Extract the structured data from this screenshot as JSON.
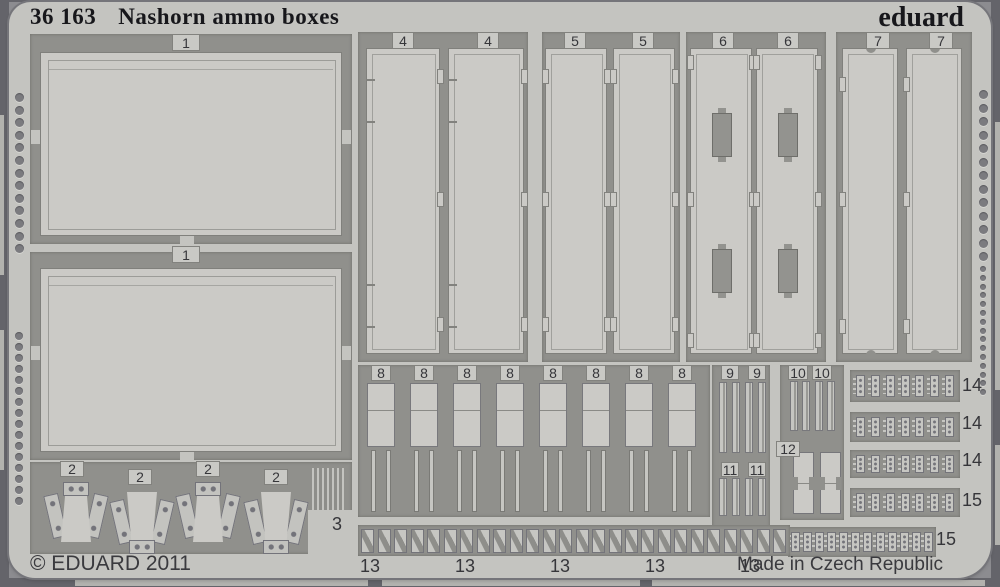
{
  "header": {
    "catalog_number": "36 163",
    "product_title": "Nashorn ammo boxes",
    "brand": "eduard"
  },
  "footer": {
    "copyright": "© EDUARD 2011",
    "made_in": "Made in Czech Republic"
  },
  "part_labels": {
    "p1": "1",
    "p2": "2",
    "p3": "3",
    "p4": "4",
    "p5": "5",
    "p6": "6",
    "p7": "7",
    "p8": "8",
    "p9": "9",
    "p10": "10",
    "p11": "11",
    "p12": "12",
    "p13": "13",
    "p14": "14",
    "p15": "15"
  },
  "parts_on_sheet": [
    {
      "number": "1",
      "labels_visible": 2
    },
    {
      "number": "2",
      "labels_visible": 4
    },
    {
      "number": "3",
      "labels_visible": 1
    },
    {
      "number": "4",
      "labels_visible": 2
    },
    {
      "number": "5",
      "labels_visible": 2
    },
    {
      "number": "6",
      "labels_visible": 2
    },
    {
      "number": "7",
      "labels_visible": 2
    },
    {
      "number": "8",
      "labels_visible": 8
    },
    {
      "number": "9",
      "labels_visible": 2
    },
    {
      "number": "10",
      "labels_visible": 2
    },
    {
      "number": "11",
      "labels_visible": 2
    },
    {
      "number": "12",
      "labels_visible": 1
    },
    {
      "number": "13",
      "labels_visible": 5
    },
    {
      "number": "14",
      "labels_visible": 3
    },
    {
      "number": "15",
      "labels_visible": 2
    }
  ],
  "colors": {
    "sheet": "#c4c4c0",
    "panel": "#cbcac6",
    "cutout": "#90908c",
    "background": "#8c8c90",
    "edge_dark": "#64646a",
    "edge_light": "#b2b2ae",
    "detail_line": "#82827e",
    "hole": "#7b7b7f",
    "text_dark": "#17171b",
    "label_text": "#36363a"
  }
}
